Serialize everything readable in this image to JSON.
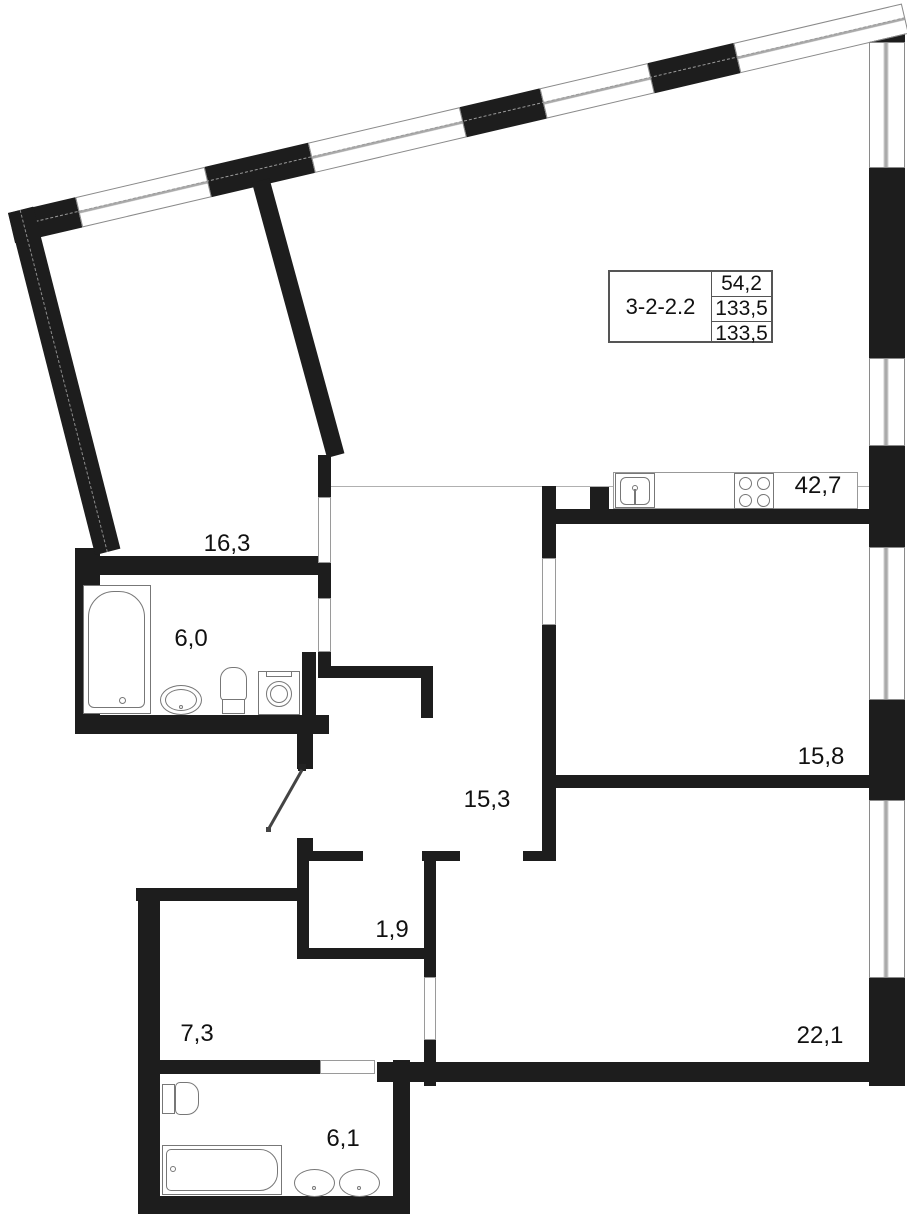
{
  "title_block": {
    "unit_id": "3-2-2.2",
    "values": [
      "54,2",
      "133,5",
      "133,5"
    ]
  },
  "rooms": [
    {
      "id": "room-16-3",
      "area": "16,3"
    },
    {
      "id": "bathroom-6-0",
      "area": "6,0"
    },
    {
      "id": "kitchen-living-42-7",
      "area": "42,7"
    },
    {
      "id": "bedroom-15-8",
      "area": "15,8"
    },
    {
      "id": "hall-15-3",
      "area": "15,3"
    },
    {
      "id": "closet-1-9",
      "area": "1,9"
    },
    {
      "id": "corridor-7-3",
      "area": "7,3"
    },
    {
      "id": "bedroom-22-1",
      "area": "22,1"
    },
    {
      "id": "bathroom-6-1",
      "area": "6,1"
    }
  ],
  "fixtures": [
    "bathtub-icon",
    "washbasin-icon",
    "toilet-icon",
    "washing-machine-icon",
    "kitchen-sink-icon",
    "stove-icon",
    "double-washbasin-icon",
    "entry-door-icon"
  ],
  "colors": {
    "wall": "#1d1d1d",
    "window_frame": "#8a8a8a",
    "fixture_outline": "#777777"
  }
}
